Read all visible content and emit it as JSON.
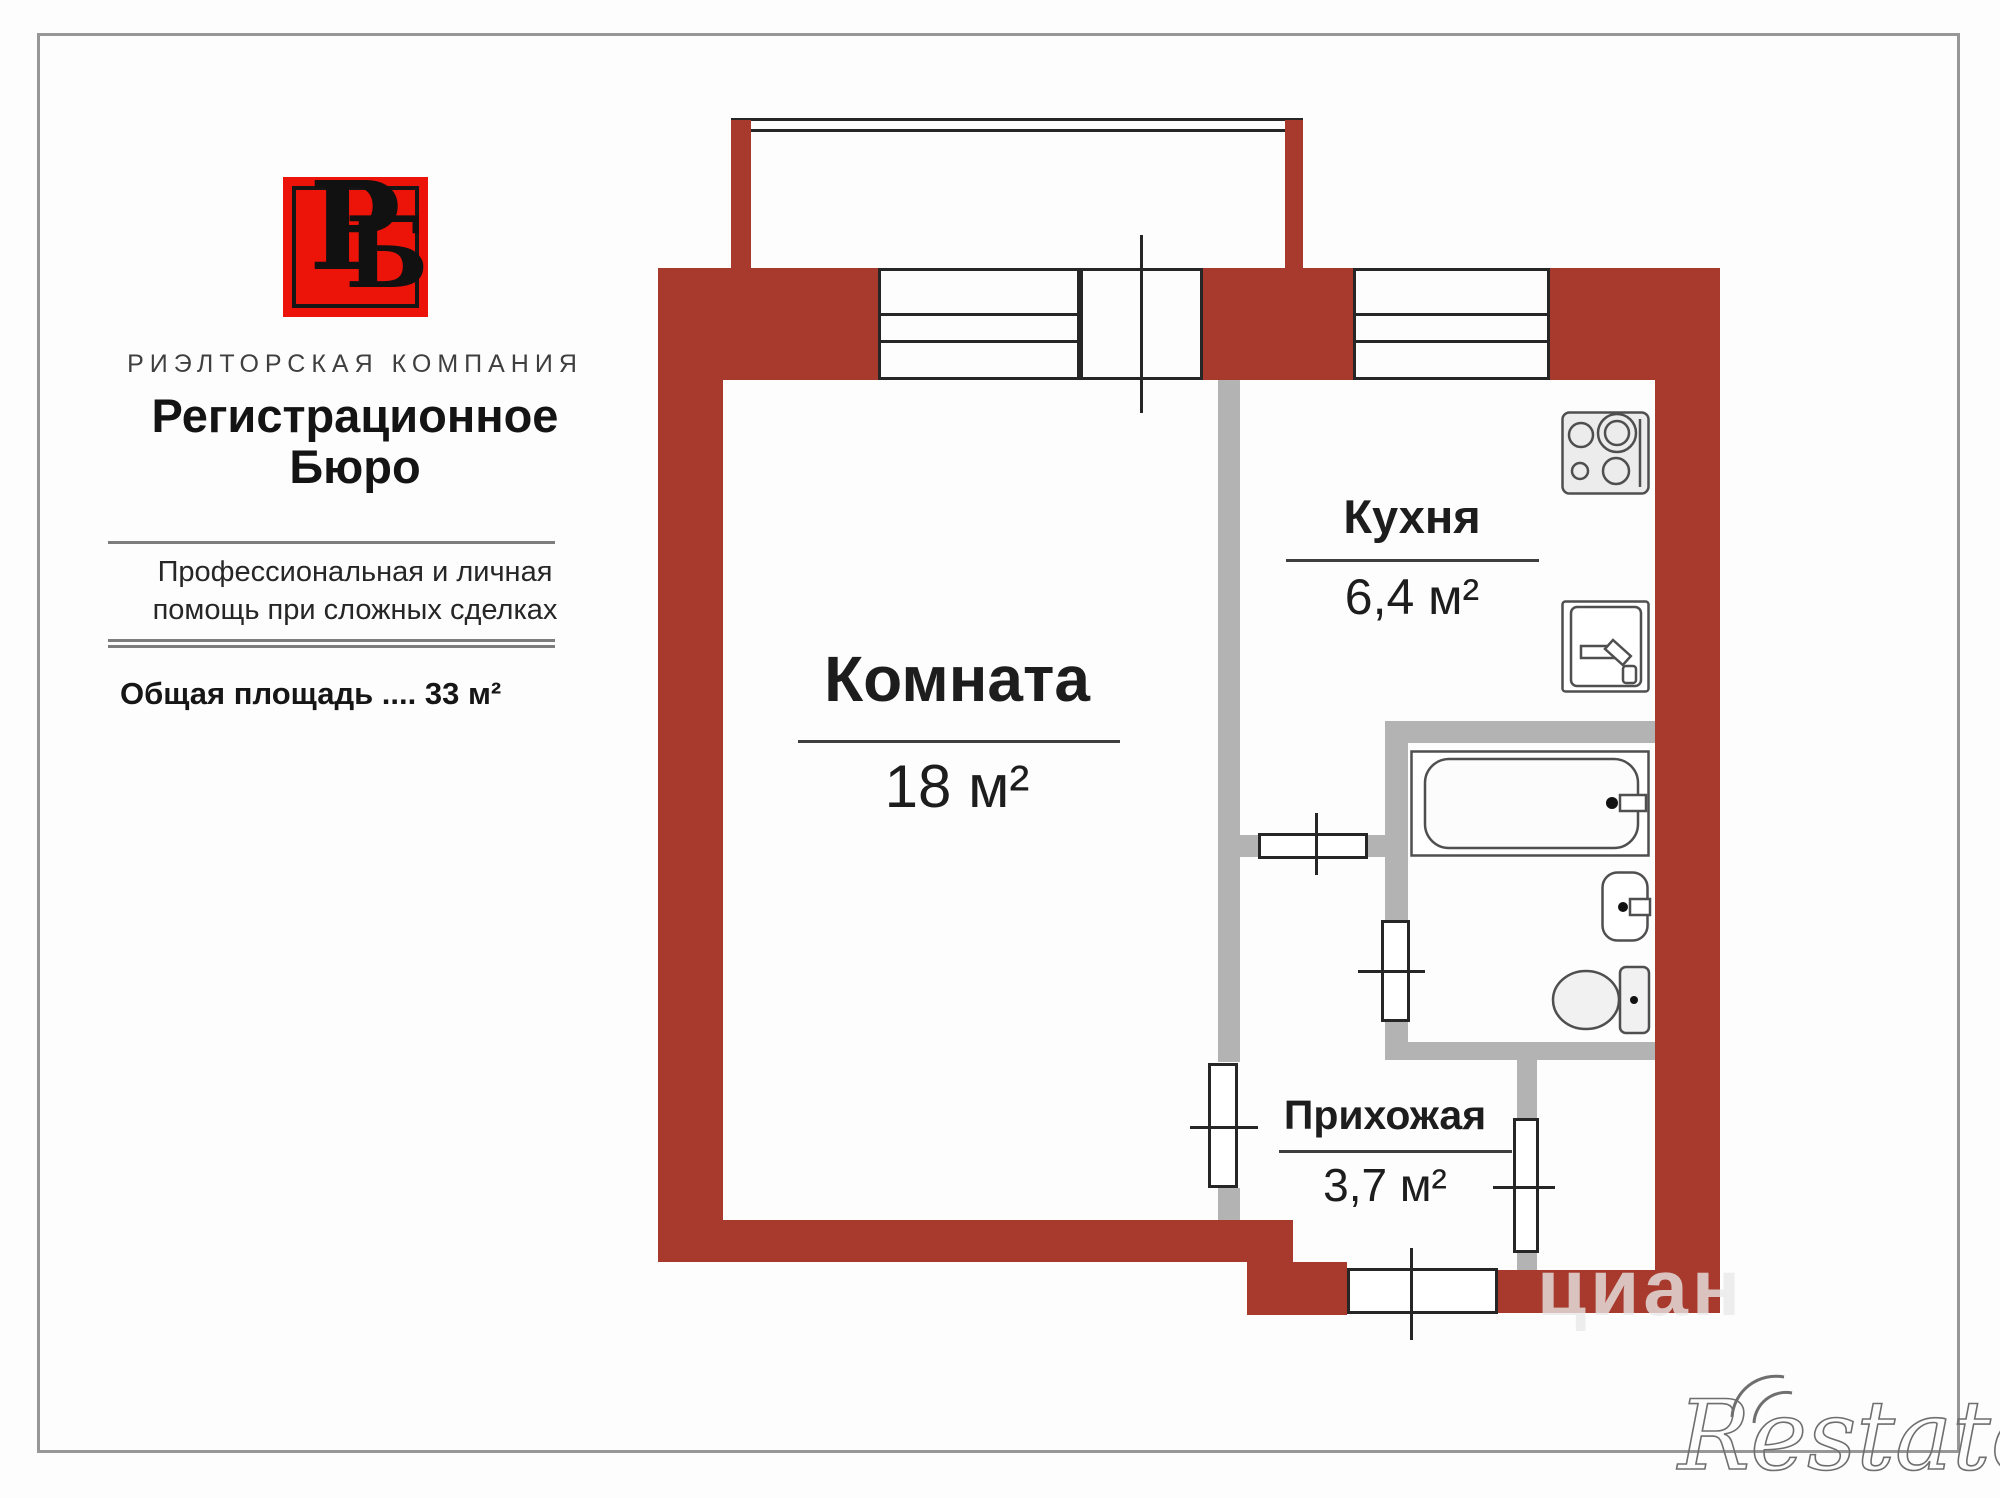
{
  "brand": {
    "logo_letters": {
      "first": "Р",
      "second": "Б"
    },
    "company_type": "РИЭЛТОРСКАЯ КОМПАНИЯ",
    "company_name_line1": "Регистрационное",
    "company_name_line2": "Бюро",
    "tagline_line1": "Профессиональная и личная",
    "tagline_line2": "помощь при сложных сделках",
    "total_area": "Общая площадь ....  33 м²"
  },
  "plan": {
    "rooms": [
      {
        "name": "Комната",
        "area": "18 м²"
      },
      {
        "name": "Кухня",
        "area": "6,4 м²"
      },
      {
        "name": "Прихожая",
        "area": "3,7 м²"
      }
    ]
  },
  "watermarks": {
    "cian": "циан",
    "restate": "Restate"
  },
  "colors": {
    "wall_red": "#a73a2d",
    "logo_red": "#ec1309",
    "interior_gray": "#b3b3b3",
    "line_black": "#262626"
  }
}
